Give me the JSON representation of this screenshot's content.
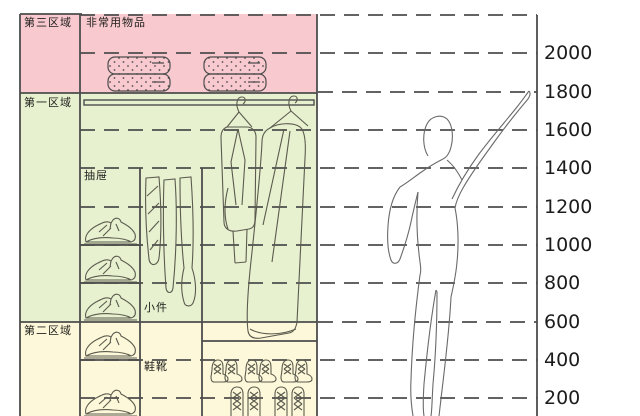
{
  "zones": {
    "zone3": {
      "label": "第三区域",
      "annotation": "非常用物品"
    },
    "zone1": {
      "label": "第一区域",
      "annotation_drawer": "抽屉",
      "annotation_small": "小件"
    },
    "zone2": {
      "label": "第二区域",
      "annotation_shoes": "鞋靴"
    }
  },
  "scale": {
    "unit_implied": "mm",
    "ticks": [
      "2000",
      "1800",
      "1600",
      "1400",
      "1200",
      "1000",
      "800",
      "600",
      "400",
      "200"
    ]
  },
  "colors": {
    "zone3_fill": "#f8c9cf",
    "zone1_fill": "#e7f1d0",
    "zone2_fill": "#fdf8d9",
    "line": "#4d4d4d",
    "sketch": "#5b5b4e",
    "tick_text": "#1c1c1c"
  },
  "icons": {
    "quilt": "quilt-stack-icon",
    "pile": "shoe-pair-icon",
    "boots": "tall-boots-icon",
    "coat": "hanging-coat-icon",
    "ankle_boots": "ankle-boots-icon",
    "boot_pair": "tall-boot-pair-icon",
    "human": "human-figure-icon",
    "rod": "closet-rod"
  }
}
